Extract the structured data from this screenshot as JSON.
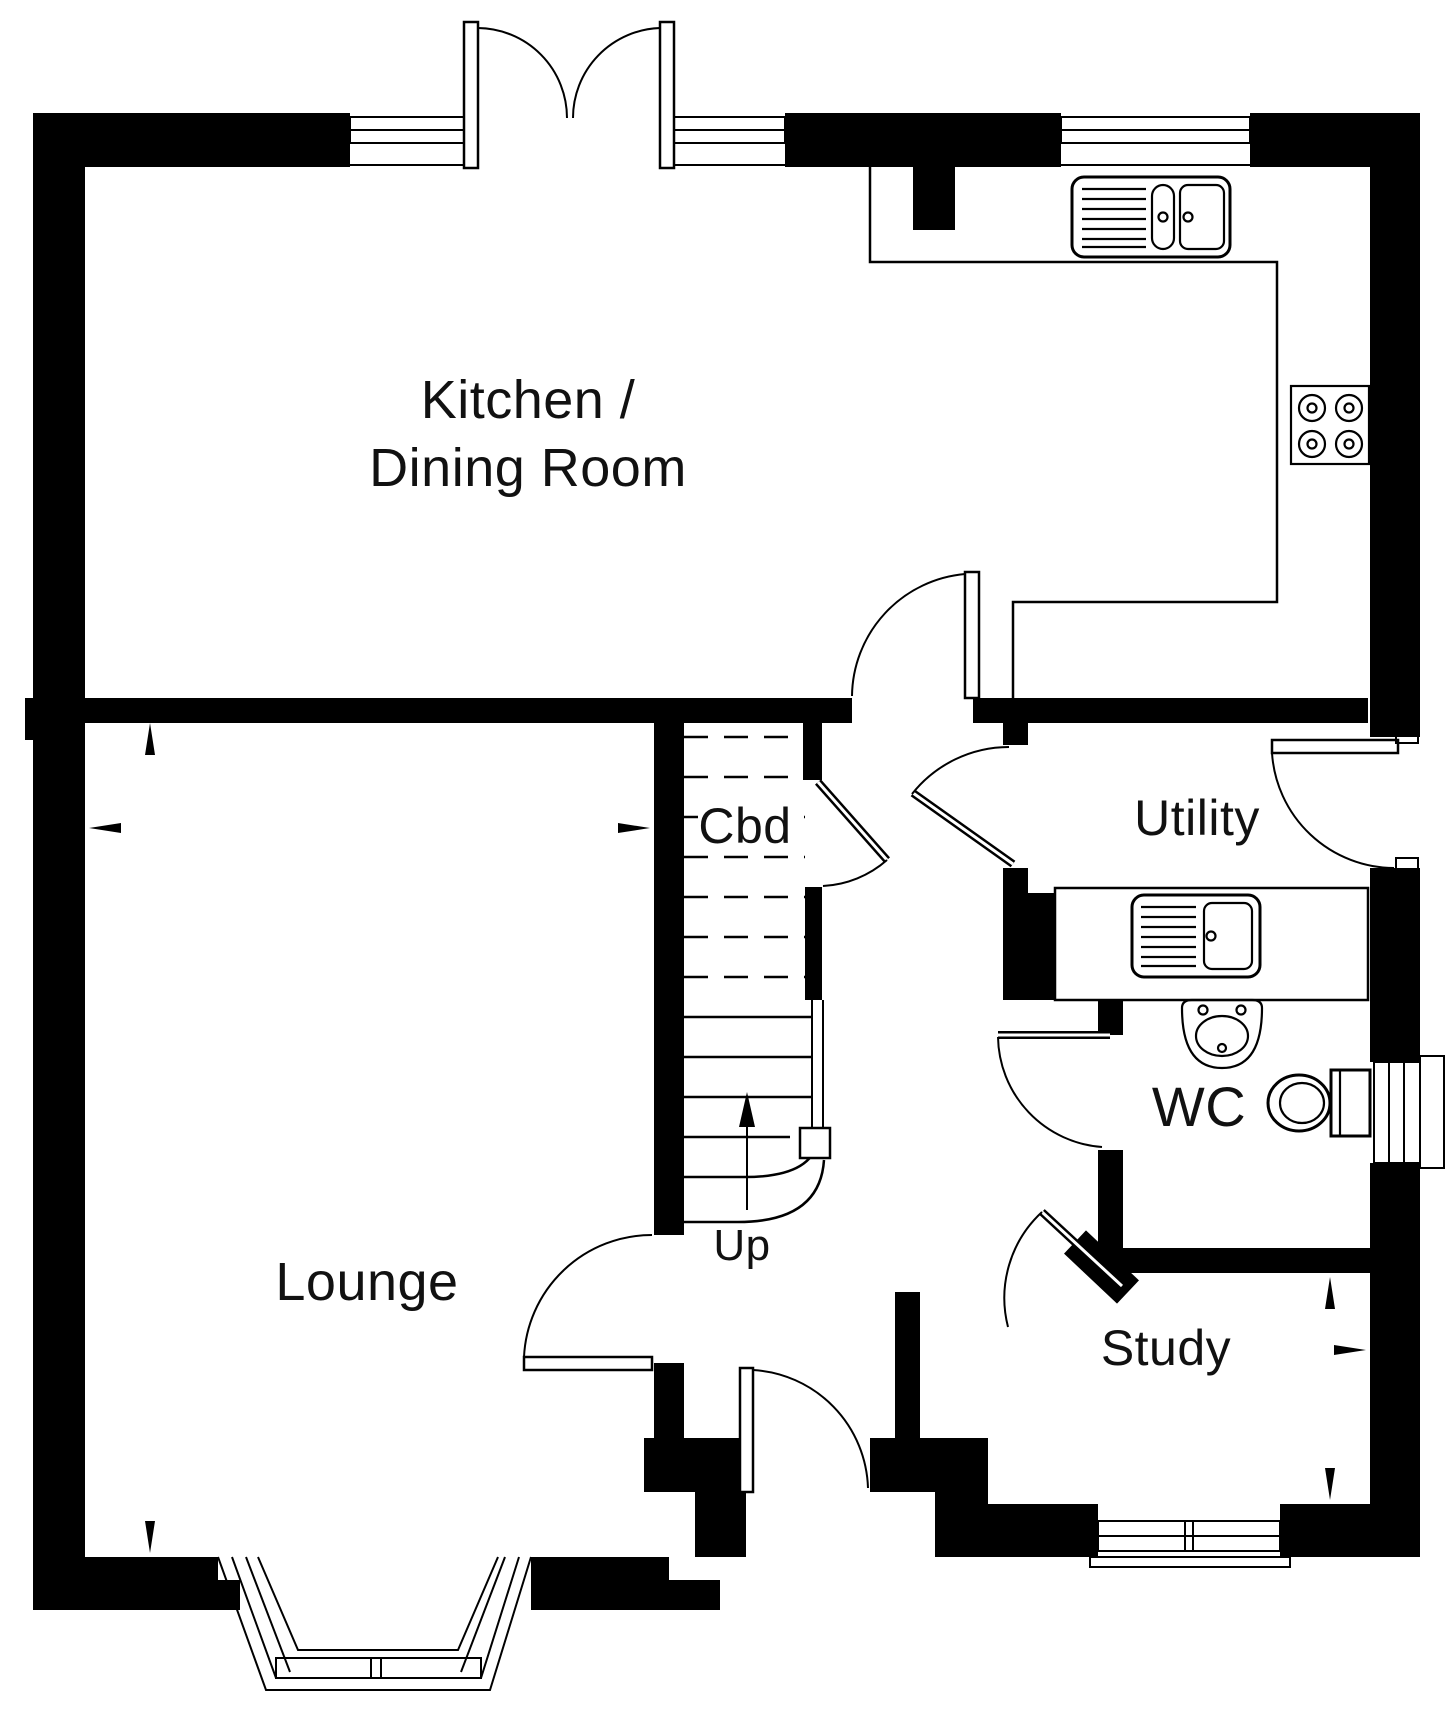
{
  "page": {
    "background": "#ffffff",
    "ink": "#000000",
    "type_label": "floor-plan"
  },
  "floor_plan": {
    "rooms": [
      {
        "id": "kitchen-dining",
        "label_line1": "Kitchen /",
        "label_line2": "Dining Room"
      },
      {
        "id": "lounge",
        "label": "Lounge"
      },
      {
        "id": "cupboard",
        "label": "Cbd"
      },
      {
        "id": "utility",
        "label": "Utility"
      },
      {
        "id": "wc",
        "label": "WC"
      },
      {
        "id": "study",
        "label": "Study"
      }
    ],
    "stairs": {
      "direction_label": "Up"
    },
    "fixtures": [
      "french-doors",
      "kitchen-sink",
      "hob",
      "kitchen-counter",
      "utility-sink",
      "utility-counter",
      "wash-basin",
      "toilet",
      "staircase",
      "under-stairs-cupboard",
      "bay-window",
      "front-door",
      "lounge-door",
      "kitchen-door",
      "utility-door",
      "utility-external-door",
      "wc-door",
      "study-door"
    ]
  }
}
